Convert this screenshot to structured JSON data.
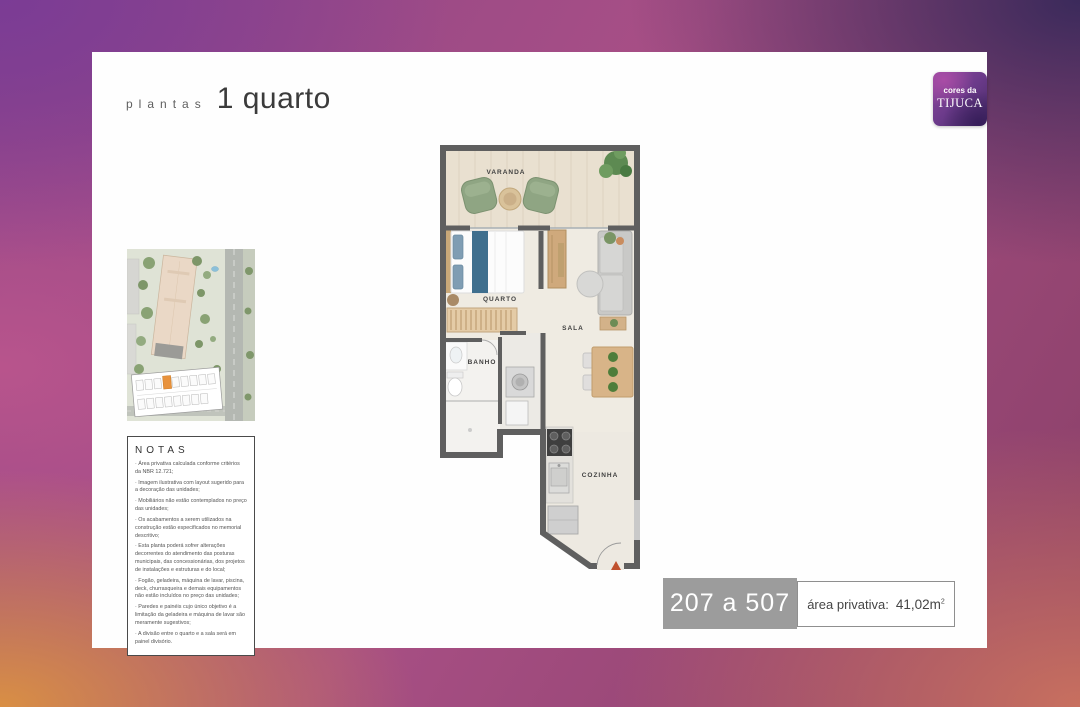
{
  "page": {
    "title_prefix": "plantas",
    "title_main": "1 quarto"
  },
  "logo": {
    "line1": "cores da",
    "line2": "TIJUCA"
  },
  "notas": {
    "title": "NOTAS",
    "items": [
      "· Área privativa calculada conforme critérios da NBR 12.721;",
      "· Imagem ilustrativa com layout sugerido para a decoração das unidades;",
      "· Mobiliários não estão contemplados no preço das unidades;",
      "· Os acabamentos a serem utilizados na construção estão especificados no memorial descritivo;",
      "· Esta planta poderá sofrer alterações decorrentes do atendimento das posturas municipais, das concessionárias, dos projetos de instalações e estruturas e do local;",
      "· Fogão, geladeira, máquina de lavar, piscina, deck, churrasqueira e demais equipamentos não estão incluídos no preço das unidades;",
      "· Paredes e painéis cujo único objetivo é a limitação da geladeira e máquina de lavar são meramente sugestivos;",
      "· A divisão entre o quarto e a sala será em painel divisório."
    ]
  },
  "plan": {
    "rooms": {
      "varanda": "VARANDA",
      "quarto": "QUARTO",
      "sala": "SALA",
      "banho": "BANHO",
      "cozinha": "COZINHA"
    }
  },
  "badge": {
    "units": "207 a 507",
    "area_label": "área privativa:",
    "area_value": "41,02m",
    "area_sup": "2"
  },
  "colors": {
    "gradient_top_left": "#7b3c95",
    "gradient_top_right": "#3b2a5b",
    "gradient_bottom_left": "#d98f44",
    "gradient_bottom_right": "#c8705f",
    "logo_purple": "#6b3a8a",
    "badge_gray": "#9c9c9c",
    "unit_highlight_orange": "#e8923c",
    "entry_arrow_orange": "#c0512e",
    "wall_gray": "#5f5f5f"
  }
}
